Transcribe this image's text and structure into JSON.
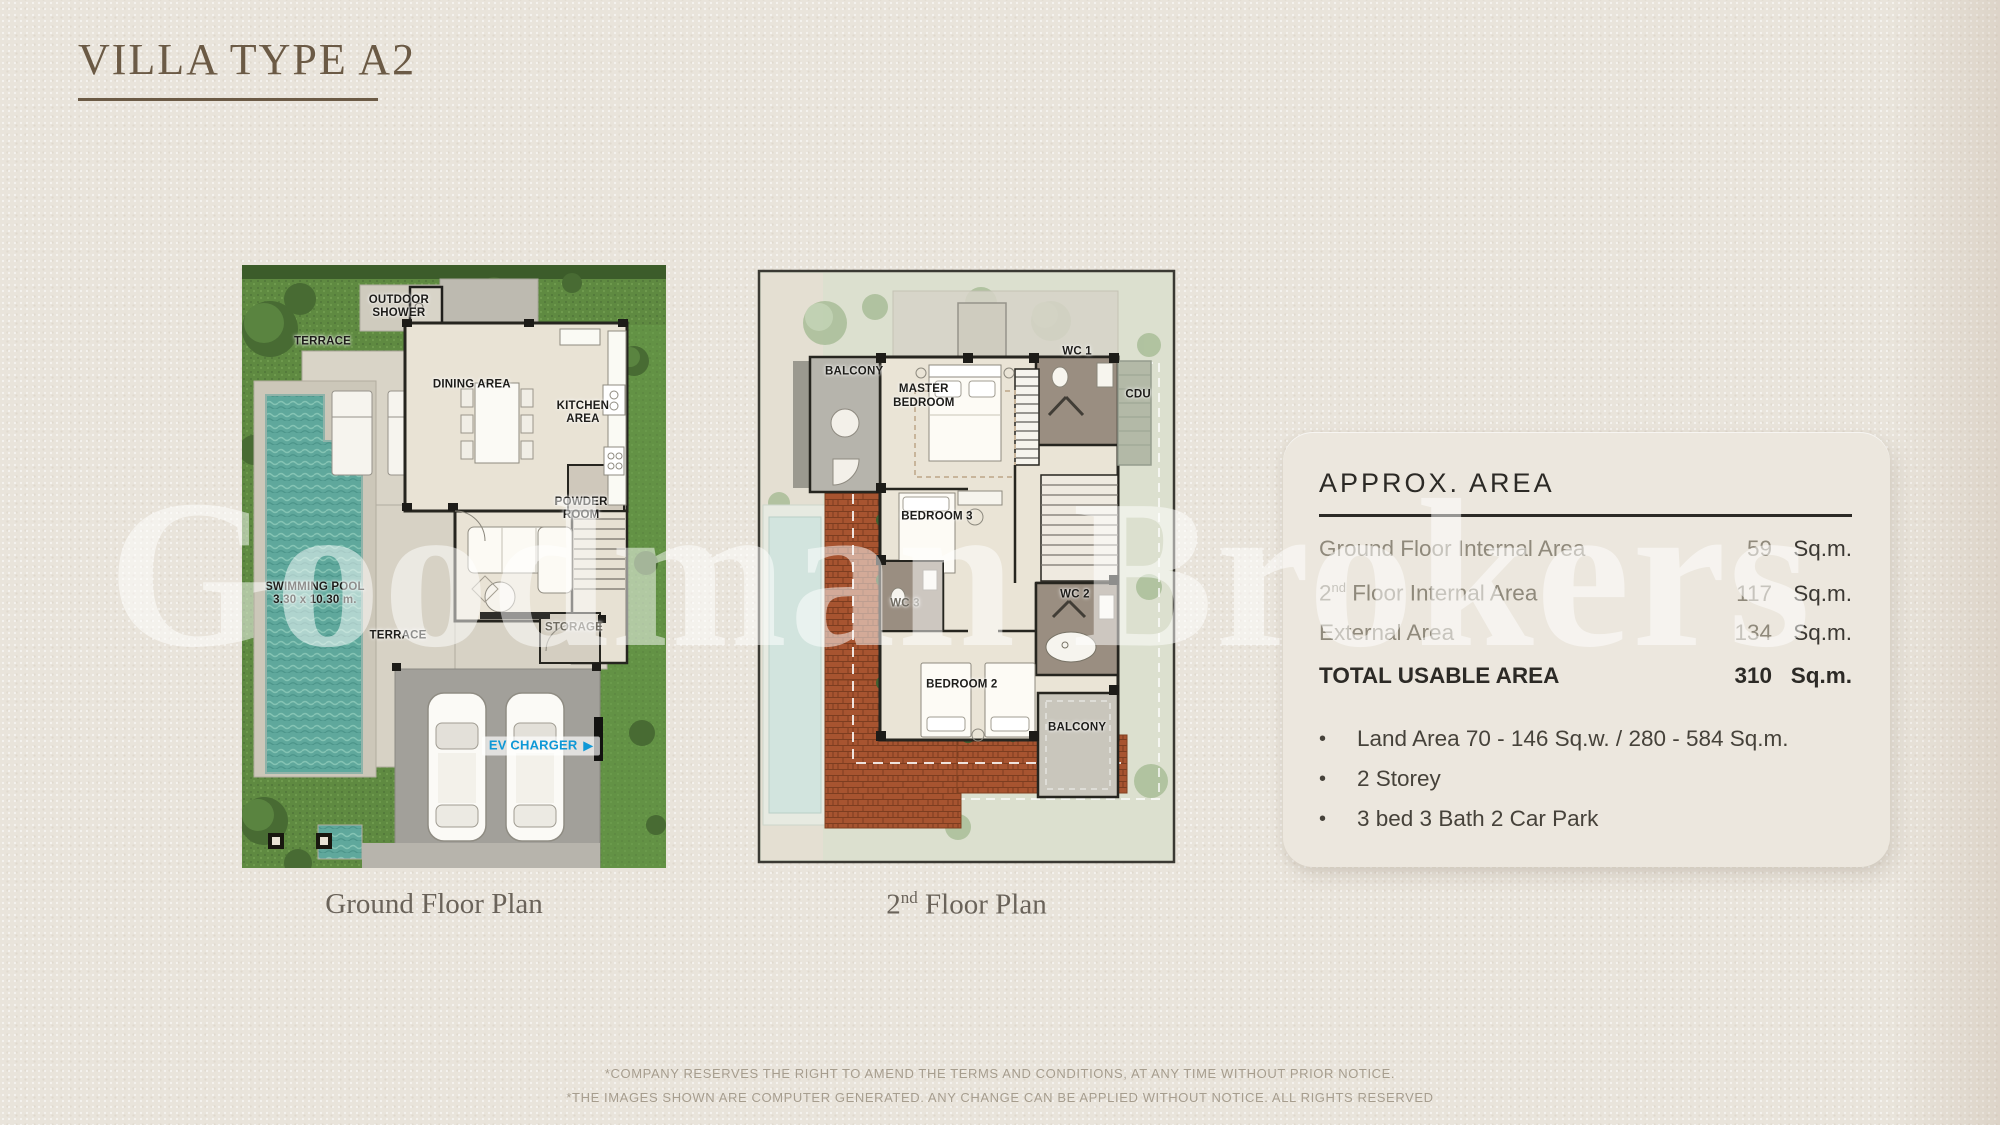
{
  "page": {
    "title": "VILLA TYPE A2",
    "watermark": "Goodman Brokers",
    "footer_line1": "*COMPANY RESERVES THE RIGHT TO AMEND THE TERMS AND CONDITIONS, AT ANY TIME WITHOUT PRIOR NOTICE.",
    "footer_line2": "*THE IMAGES SHOWN ARE COMPUTER GENERATED. ANY CHANGE CAN BE APPLIED WITHOUT NOTICE. ALL RIGHTS RESERVED"
  },
  "ground_plan": {
    "caption": "Ground Floor Plan",
    "labels": {
      "outdoor_shower": "OUTDOOR SHOWER",
      "terrace_top": "TERRACE",
      "dining": "DINING AREA",
      "kitchen": "KITCHEN AREA",
      "powder": "POWDER ROOM",
      "pool_name": "SWIMMING POOL",
      "pool_size": "3.30 x 10.30 m.",
      "terrace_bottom": "TERRACE",
      "storage": "STORAGE",
      "ev_charger": "EV CHARGER",
      "ev_arrow": "▶"
    }
  },
  "second_plan": {
    "caption_num": "2",
    "caption_sup": "nd",
    "caption_rest": " Floor Plan",
    "labels": {
      "balcony_top": "BALCONY",
      "master_bedroom": "MASTER BEDROOM",
      "wc1": "WC 1",
      "cdu": "CDU",
      "bedroom3": "BEDROOM 3",
      "wc3": "WC 3",
      "wc2": "WC 2",
      "bedroom2": "BEDROOM 2",
      "balcony_bottom": "BALCONY"
    }
  },
  "area_panel": {
    "heading": "APPROX. AREA",
    "rows": [
      {
        "label": "Ground Floor Internal Area",
        "value": "59",
        "unit": "Sq.m."
      },
      {
        "label_num": "2",
        "label_sup": "nd",
        "label_rest": " Floor Internal Area",
        "value": "117",
        "unit": "Sq.m."
      },
      {
        "label": "External Area",
        "value": "134",
        "unit": "Sq.m."
      }
    ],
    "total": {
      "label": "TOTAL USABLE AREA",
      "value": "310",
      "unit": "Sq.m."
    },
    "bullet_char": "•",
    "bullets": [
      "Land Area 70 - 146 Sq.w. / 280 - 584 Sq.m.",
      "2 Storey",
      "3 bed 3 Bath 2 Car Park"
    ]
  },
  "colors": {
    "accent_ev": "#0f98d6",
    "title_brown": "#6b5a45",
    "lawn_green": "#5f8a41",
    "pool_teal": "#5fa89c",
    "brick_roof": "#a75430",
    "panel_bg": "#ece7de"
  }
}
